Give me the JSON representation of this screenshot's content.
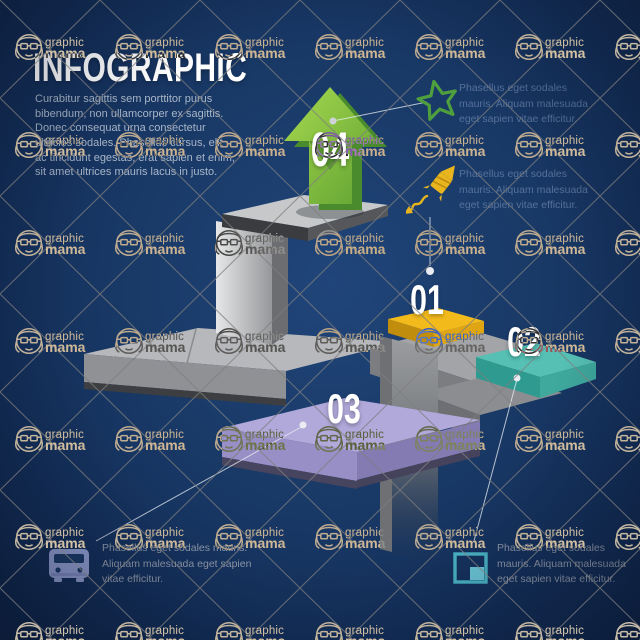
{
  "watermark": {
    "word_top": "graphic",
    "word_bottom": "mama"
  },
  "header": {
    "title": "INFOGRAPHIC",
    "intro": "Curabitur sagittis sem porttitor purus bibendum, non ullamcorper ex sagittis. Donec consequat urna consectetur ultricies sodales. Phasellus cursus, elit ac tincidunt egestas, erat sapien et enim, sit amet ultrices mauris lacus in justo."
  },
  "steps": [
    {
      "number": "01",
      "color": "#f3ba1c"
    },
    {
      "number": "02",
      "color": "#56c0b4"
    },
    {
      "number": "03",
      "color": "#b1a9da"
    },
    {
      "number": "04",
      "color": "#7cbd42"
    }
  ],
  "callouts": [
    {
      "icon": "star-icon",
      "text": "Phasellus eget sodales mauris. Aliquam malesuada eget sapien vitae efficitur."
    },
    {
      "icon": "firework-icon",
      "text": "Phasellus eget sodales mauris. Aliquam malesuada eget sapien vitae efficitur."
    },
    {
      "icon": "bus-icon",
      "text": "Phasellus eget sodales mauris. Aliquam malesuada eget sapien vitae efficitur."
    },
    {
      "icon": "chart-icon",
      "text": "Phasellus eget sodales mauris. Aliquam malesuada eget sapien vitae efficitur."
    }
  ],
  "colors": {
    "background": "#17396b",
    "platform_gray": "#b6b8bb",
    "accent_green": "#7cbd42",
    "accent_yellow": "#f3ba1c",
    "accent_teal": "#56c0b4",
    "accent_purple": "#b1a9da",
    "icon_star": "#4f9f3e",
    "icon_firework": "#e8b51f",
    "icon_bus": "#98a4d6",
    "icon_chart": "#4ab5c7"
  }
}
